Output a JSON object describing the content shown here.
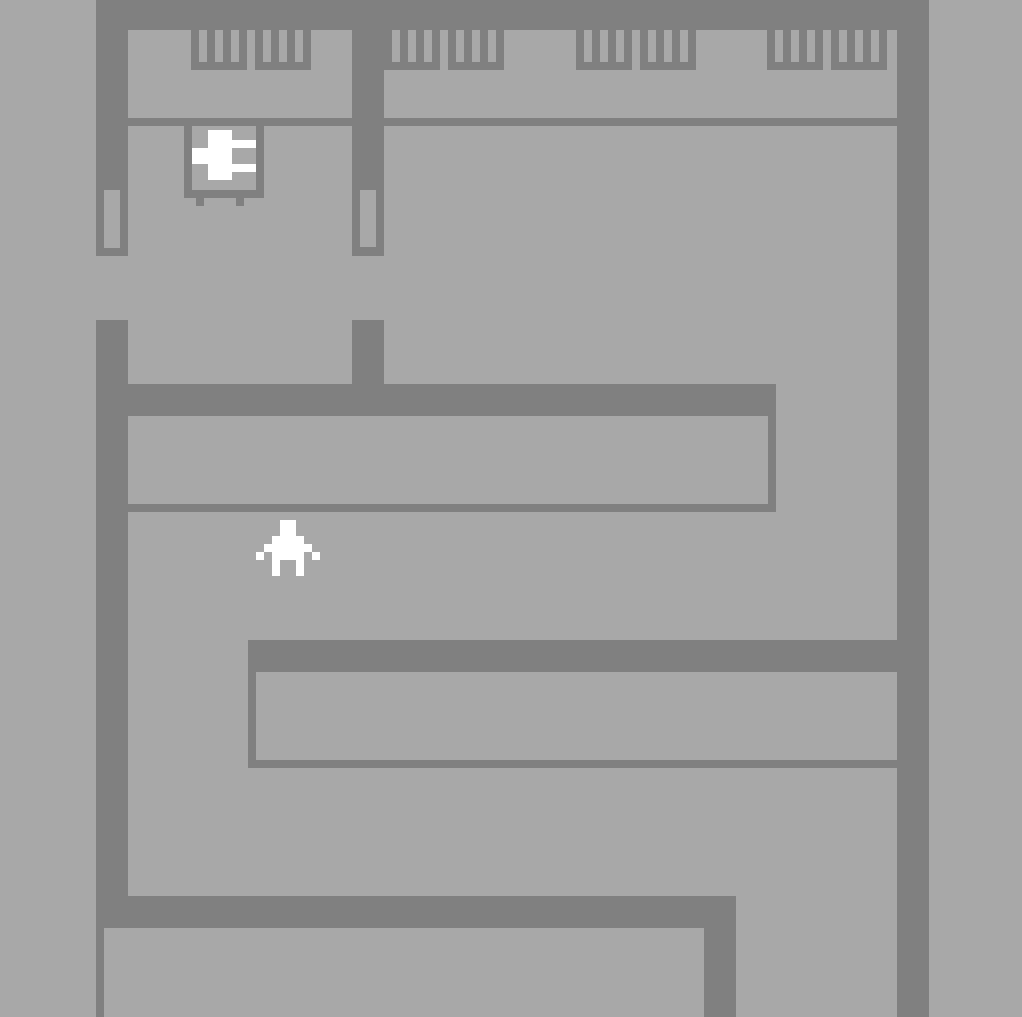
{
  "meta": {
    "width": 1022,
    "height": 1017
  },
  "palette": {
    "floor": "#a8a8a8",
    "wall": "#808080",
    "sprite": "#ffffff"
  },
  "map": {
    "rects": [
      {
        "name": "top-wall",
        "color": "wall",
        "x": 96,
        "y": 0,
        "w": 833,
        "h": 30
      },
      {
        "name": "left-wall-upper",
        "color": "wall",
        "x": 96,
        "y": 0,
        "w": 32,
        "h": 256
      },
      {
        "name": "left-wall-lower",
        "color": "wall",
        "x": 96,
        "y": 320,
        "w": 32,
        "h": 576
      },
      {
        "name": "divider-wall-upper",
        "color": "wall",
        "x": 352,
        "y": 30,
        "w": 32,
        "h": 226
      },
      {
        "name": "divider-wall-stub",
        "color": "wall",
        "x": 352,
        "y": 320,
        "w": 32,
        "h": 64
      },
      {
        "name": "right-wall",
        "color": "wall",
        "x": 897,
        "y": 0,
        "w": 32,
        "h": 1017
      },
      {
        "name": "lab-wall-bar",
        "color": "wall",
        "x": 128,
        "y": 118,
        "w": 769,
        "h": 8
      },
      {
        "name": "console-1",
        "color": "wall",
        "x": 191,
        "y": 30,
        "w": 56,
        "h": 40
      },
      {
        "name": "console-1-slot-1",
        "color": "floor",
        "x": 199,
        "y": 30,
        "w": 8,
        "h": 32
      },
      {
        "name": "console-1-slot-2",
        "color": "floor",
        "x": 215,
        "y": 30,
        "w": 8,
        "h": 32
      },
      {
        "name": "console-1-slot-3",
        "color": "floor",
        "x": 231,
        "y": 30,
        "w": 8,
        "h": 32
      },
      {
        "name": "console-2",
        "color": "wall",
        "x": 255,
        "y": 30,
        "w": 56,
        "h": 40
      },
      {
        "name": "console-2-slot-1",
        "color": "floor",
        "x": 263,
        "y": 30,
        "w": 8,
        "h": 32
      },
      {
        "name": "console-2-slot-2",
        "color": "floor",
        "x": 279,
        "y": 30,
        "w": 8,
        "h": 32
      },
      {
        "name": "console-2-slot-3",
        "color": "floor",
        "x": 295,
        "y": 30,
        "w": 8,
        "h": 32
      },
      {
        "name": "console-3",
        "color": "wall",
        "x": 384,
        "y": 30,
        "w": 56,
        "h": 40
      },
      {
        "name": "console-3-slot-1",
        "color": "floor",
        "x": 392,
        "y": 30,
        "w": 8,
        "h": 32
      },
      {
        "name": "console-3-slot-2",
        "color": "floor",
        "x": 408,
        "y": 30,
        "w": 8,
        "h": 32
      },
      {
        "name": "console-3-slot-3",
        "color": "floor",
        "x": 424,
        "y": 30,
        "w": 8,
        "h": 32
      },
      {
        "name": "console-4",
        "color": "wall",
        "x": 448,
        "y": 30,
        "w": 56,
        "h": 40
      },
      {
        "name": "console-4-slot-1",
        "color": "floor",
        "x": 456,
        "y": 30,
        "w": 8,
        "h": 32
      },
      {
        "name": "console-4-slot-2",
        "color": "floor",
        "x": 472,
        "y": 30,
        "w": 8,
        "h": 32
      },
      {
        "name": "console-4-slot-3",
        "color": "floor",
        "x": 488,
        "y": 30,
        "w": 8,
        "h": 32
      },
      {
        "name": "console-5",
        "color": "wall",
        "x": 576,
        "y": 30,
        "w": 56,
        "h": 40
      },
      {
        "name": "console-5-slot-1",
        "color": "floor",
        "x": 584,
        "y": 30,
        "w": 8,
        "h": 32
      },
      {
        "name": "console-5-slot-2",
        "color": "floor",
        "x": 600,
        "y": 30,
        "w": 8,
        "h": 32
      },
      {
        "name": "console-5-slot-3",
        "color": "floor",
        "x": 616,
        "y": 30,
        "w": 8,
        "h": 32
      },
      {
        "name": "console-6",
        "color": "wall",
        "x": 640,
        "y": 30,
        "w": 56,
        "h": 40
      },
      {
        "name": "console-6-slot-1",
        "color": "floor",
        "x": 648,
        "y": 30,
        "w": 8,
        "h": 32
      },
      {
        "name": "console-6-slot-2",
        "color": "floor",
        "x": 664,
        "y": 30,
        "w": 8,
        "h": 32
      },
      {
        "name": "console-6-slot-3",
        "color": "floor",
        "x": 680,
        "y": 30,
        "w": 8,
        "h": 32
      },
      {
        "name": "console-7",
        "color": "wall",
        "x": 767,
        "y": 30,
        "w": 56,
        "h": 40
      },
      {
        "name": "console-7-slot-1",
        "color": "floor",
        "x": 775,
        "y": 30,
        "w": 8,
        "h": 32
      },
      {
        "name": "console-7-slot-2",
        "color": "floor",
        "x": 791,
        "y": 30,
        "w": 8,
        "h": 32
      },
      {
        "name": "console-7-slot-3",
        "color": "floor",
        "x": 807,
        "y": 30,
        "w": 8,
        "h": 32
      },
      {
        "name": "console-8",
        "color": "wall",
        "x": 831,
        "y": 30,
        "w": 56,
        "h": 40
      },
      {
        "name": "console-8-slot-1",
        "color": "floor",
        "x": 839,
        "y": 30,
        "w": 8,
        "h": 32
      },
      {
        "name": "console-8-slot-2",
        "color": "floor",
        "x": 855,
        "y": 30,
        "w": 8,
        "h": 32
      },
      {
        "name": "console-8-slot-3",
        "color": "floor",
        "x": 871,
        "y": 30,
        "w": 8,
        "h": 32
      },
      {
        "name": "machine-table-frame",
        "color": "wall",
        "x": 184,
        "y": 118,
        "w": 80,
        "h": 80
      },
      {
        "name": "machine-table-interior",
        "color": "floor",
        "x": 192,
        "y": 126,
        "w": 64,
        "h": 64
      },
      {
        "name": "machine-table-leg-left",
        "color": "wall",
        "x": 196,
        "y": 198,
        "w": 8,
        "h": 8
      },
      {
        "name": "machine-table-leg-right",
        "color": "wall",
        "x": 236,
        "y": 198,
        "w": 8,
        "h": 8
      },
      {
        "name": "machine-device-core",
        "color": "sprite",
        "x": 208,
        "y": 130,
        "w": 24,
        "h": 50
      },
      {
        "name": "machine-device-arm-top-right",
        "color": "sprite",
        "x": 232,
        "y": 140,
        "w": 24,
        "h": 8
      },
      {
        "name": "machine-device-arm-left",
        "color": "sprite",
        "x": 192,
        "y": 148,
        "w": 16,
        "h": 16
      },
      {
        "name": "machine-device-arm-bottom-right",
        "color": "sprite",
        "x": 232,
        "y": 164,
        "w": 24,
        "h": 8
      },
      {
        "name": "left-wall-slot",
        "color": "floor",
        "x": 104,
        "y": 190,
        "w": 16,
        "h": 58
      },
      {
        "name": "divider-wall-slot",
        "color": "floor",
        "x": 360,
        "y": 190,
        "w": 16,
        "h": 57
      },
      {
        "name": "desk1-top-edge",
        "color": "wall",
        "x": 128,
        "y": 384,
        "w": 648,
        "h": 32
      },
      {
        "name": "desk1-right-edge",
        "color": "wall",
        "x": 768,
        "y": 416,
        "w": 8,
        "h": 88
      },
      {
        "name": "desk1-bottom-edge",
        "color": "wall",
        "x": 128,
        "y": 504,
        "w": 648,
        "h": 8
      },
      {
        "name": "desk2-top-edge",
        "color": "wall",
        "x": 248,
        "y": 640,
        "w": 649,
        "h": 32
      },
      {
        "name": "desk2-left-edge",
        "color": "wall",
        "x": 248,
        "y": 672,
        "w": 8,
        "h": 88
      },
      {
        "name": "desk2-bottom-edge",
        "color": "wall",
        "x": 248,
        "y": 760,
        "w": 649,
        "h": 8
      },
      {
        "name": "bottom-wall",
        "color": "wall",
        "x": 96,
        "y": 896,
        "w": 640,
        "h": 32
      },
      {
        "name": "bottom-wall-branch",
        "color": "wall",
        "x": 704,
        "y": 928,
        "w": 32,
        "h": 89
      },
      {
        "name": "bottom-room-left-edge",
        "color": "wall",
        "x": 96,
        "y": 928,
        "w": 8,
        "h": 89
      },
      {
        "name": "player-head",
        "color": "sprite",
        "x": 280,
        "y": 520,
        "w": 16,
        "h": 16
      },
      {
        "name": "player-shoulders",
        "color": "sprite",
        "x": 272,
        "y": 536,
        "w": 32,
        "h": 8
      },
      {
        "name": "player-arms-row",
        "color": "sprite",
        "x": 264,
        "y": 544,
        "w": 48,
        "h": 8
      },
      {
        "name": "player-hand-left",
        "color": "sprite",
        "x": 256,
        "y": 552,
        "w": 8,
        "h": 8
      },
      {
        "name": "player-torso",
        "color": "sprite",
        "x": 272,
        "y": 552,
        "w": 32,
        "h": 8
      },
      {
        "name": "player-hand-right",
        "color": "sprite",
        "x": 312,
        "y": 552,
        "w": 8,
        "h": 8
      },
      {
        "name": "player-leg-left",
        "color": "sprite",
        "x": 272,
        "y": 560,
        "w": 8,
        "h": 16
      },
      {
        "name": "player-leg-right",
        "color": "sprite",
        "x": 296,
        "y": 560,
        "w": 8,
        "h": 16
      }
    ]
  }
}
